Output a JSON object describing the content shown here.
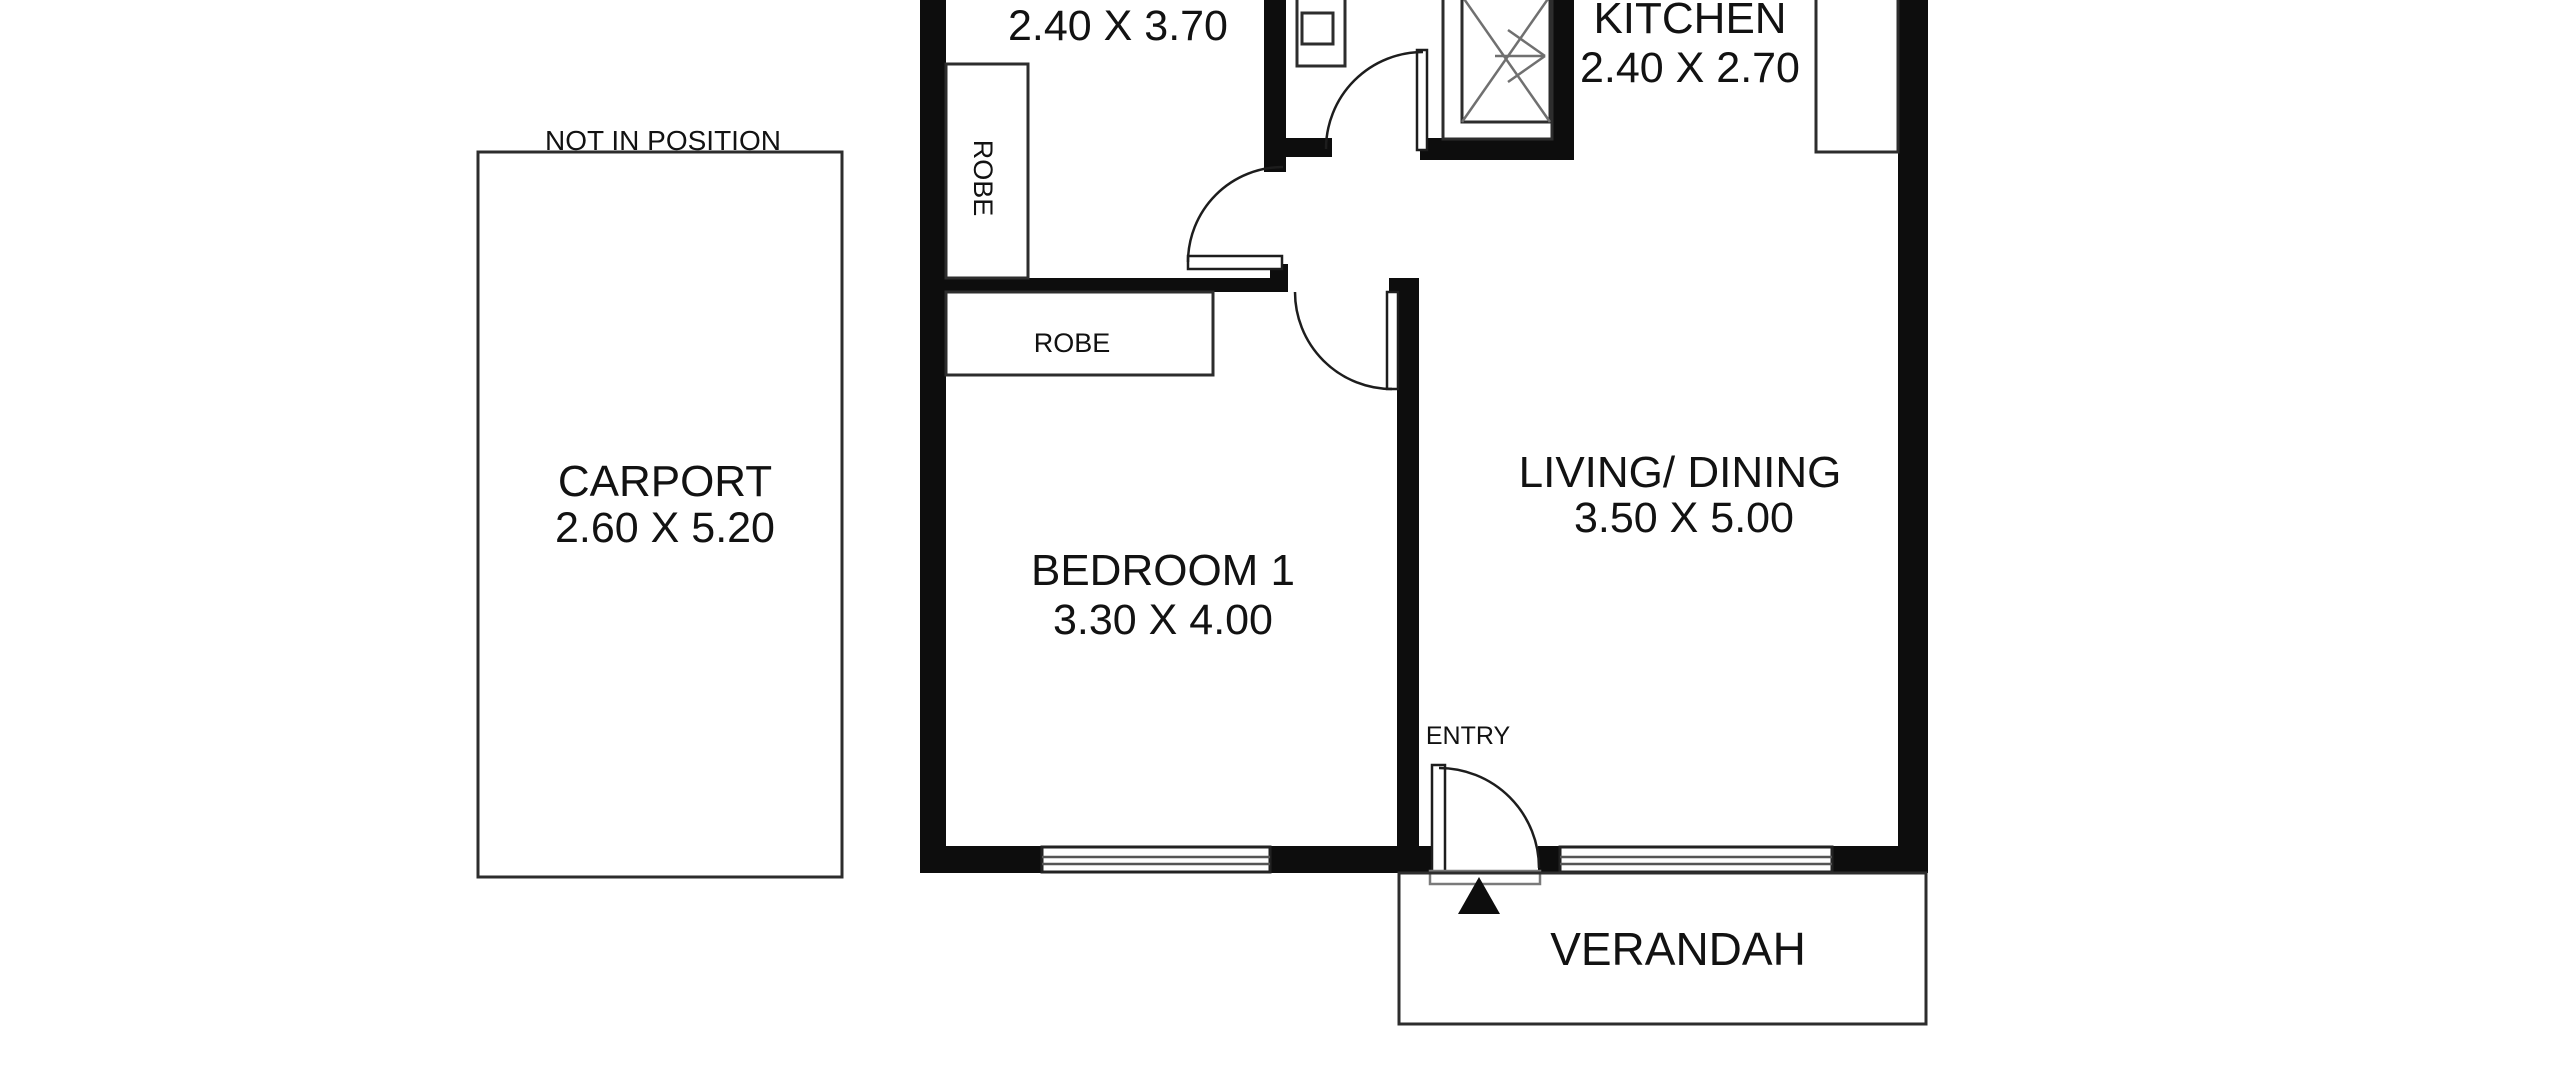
{
  "title": "Apartment floor plan",
  "colors": {
    "wall": "#0d0d0d",
    "line": "#2d2d2d",
    "text": "#121212",
    "background": "#ffffff"
  },
  "rooms": {
    "bedroom2": {
      "dims": "2.40 X 3.70"
    },
    "kitchen": {
      "name": "KITCHEN",
      "dims": "2.40 X 2.70"
    },
    "living_dining": {
      "name": "LIVING/ DINING",
      "dims": "3.50 X 5.00"
    },
    "bedroom1": {
      "name": "BEDROOM 1",
      "dims": "3.30 X 4.00"
    },
    "carport": {
      "name": "CARPORT",
      "dims": "2.60 X 5.20",
      "note": "NOT IN POSITION"
    },
    "verandah": {
      "name": "VERANDAH"
    },
    "entry": {
      "name": "ENTRY"
    }
  },
  "fixtures": {
    "robe_bedroom2": "ROBE",
    "robe_bedroom1": "ROBE"
  }
}
